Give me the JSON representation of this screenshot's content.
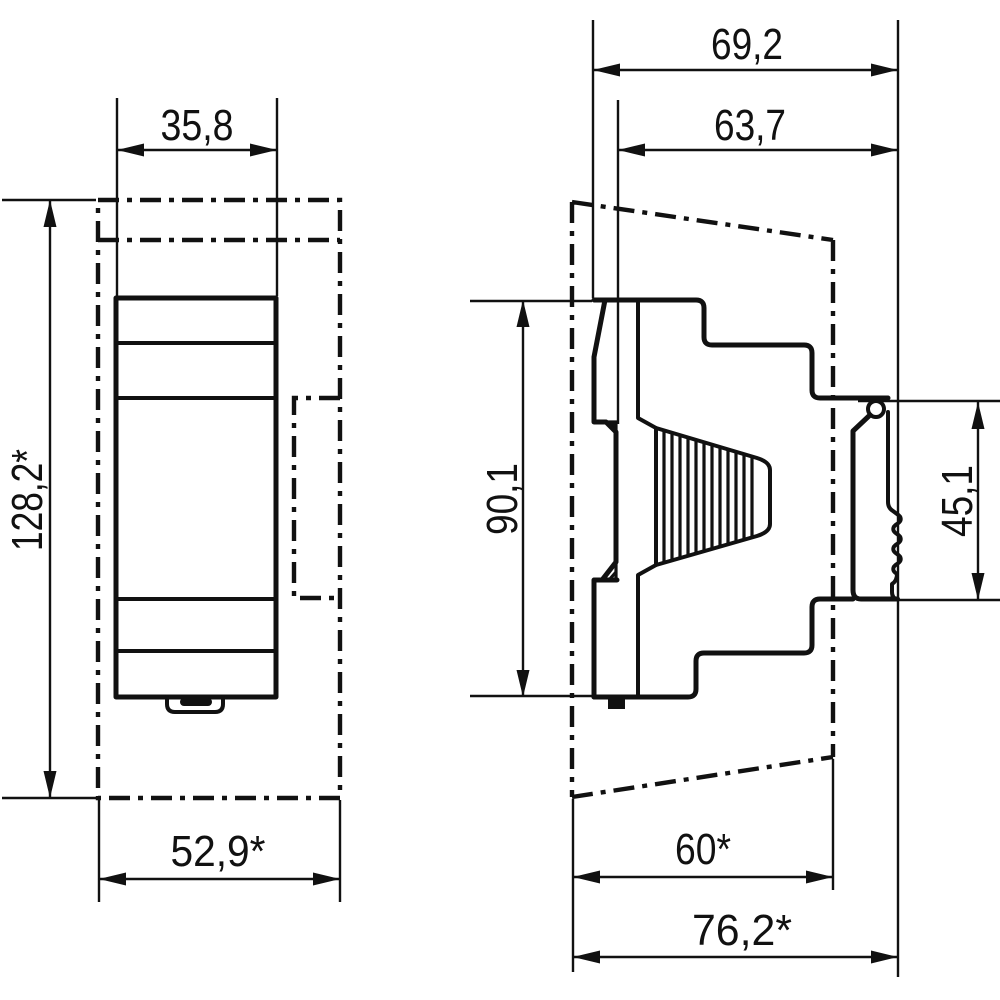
{
  "page": {
    "background": "#ffffff",
    "line_color": "#111111"
  },
  "views": {
    "front": {
      "dimensions": {
        "module_width": "35,8",
        "overall_height": "128,2*",
        "overall_width": "52,9*"
      }
    },
    "side": {
      "dimensions": {
        "overall_depth": "69,2",
        "depth_above_rail": "63,7",
        "body_height": "90,1",
        "rail_section_height": "45,1",
        "clearance_depth": "60*",
        "total_clearance_depth": "76,2*"
      }
    }
  }
}
